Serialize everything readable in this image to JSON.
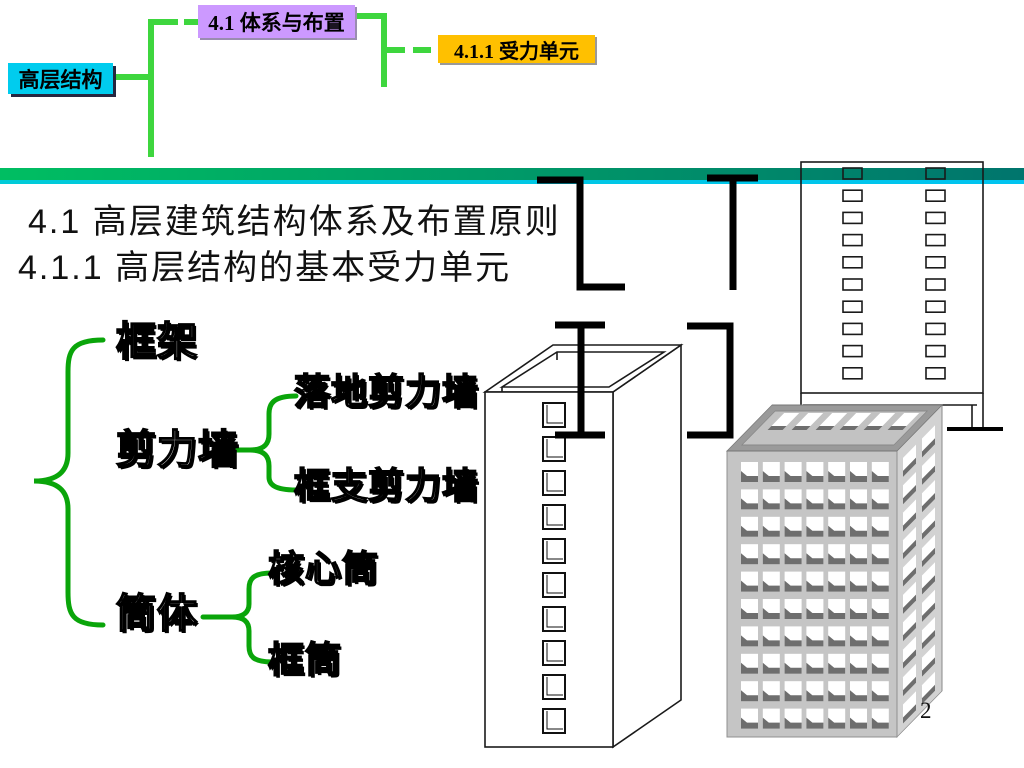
{
  "colors": {
    "org-line": "#3ed63e",
    "brace": "#0aa50a",
    "divider-left": "#00be62",
    "divider-right": "#00756d",
    "divider-edge-l": "#00cbd8",
    "divider-edge-r": "#00c4f0",
    "root-box-bg": "#00ccee",
    "child-box-bg": "#cc99ff",
    "grandchild-box-bg": "#ffc000",
    "bldg-wall": "#c5c5c5",
    "bldg-side": "#d2d2d2",
    "bldg-shadow": "#6e6e6e",
    "bldg-rim": "#9a9a9a",
    "bldg-court": "#c2c2c2"
  },
  "org_chart": {
    "root_label": "高层结构",
    "child_label": "4.1  体系与布置",
    "grandchild_label": "4.1.1  受力单元"
  },
  "headings": {
    "line1": "4.1  高层建筑结构体系及布置原则",
    "line2": "4.1.1  高层结构的基本受力单元"
  },
  "taxonomy": {
    "items": [
      {
        "label": "框架",
        "children": []
      },
      {
        "label": "剪力墙",
        "children": [
          {
            "label": "落地剪力墙"
          },
          {
            "label": "框支剪力墙"
          }
        ]
      },
      {
        "label": "筒体",
        "children": [
          {
            "label": "核心筒"
          },
          {
            "label": "框筒"
          }
        ]
      }
    ]
  },
  "figures": {
    "wall_section_shapes": [
      "z-section",
      "t-section",
      "i-section",
      "channel-section"
    ],
    "core_tube": {
      "window_rows": 10
    },
    "elevation": {
      "window_rows": 10,
      "window_cols": 2
    },
    "framed_tube": {
      "front_rows": 10,
      "front_cols": 7,
      "side_rows": 10,
      "side_cols": 2,
      "parapet_windows": 6
    }
  },
  "page_number": "2"
}
